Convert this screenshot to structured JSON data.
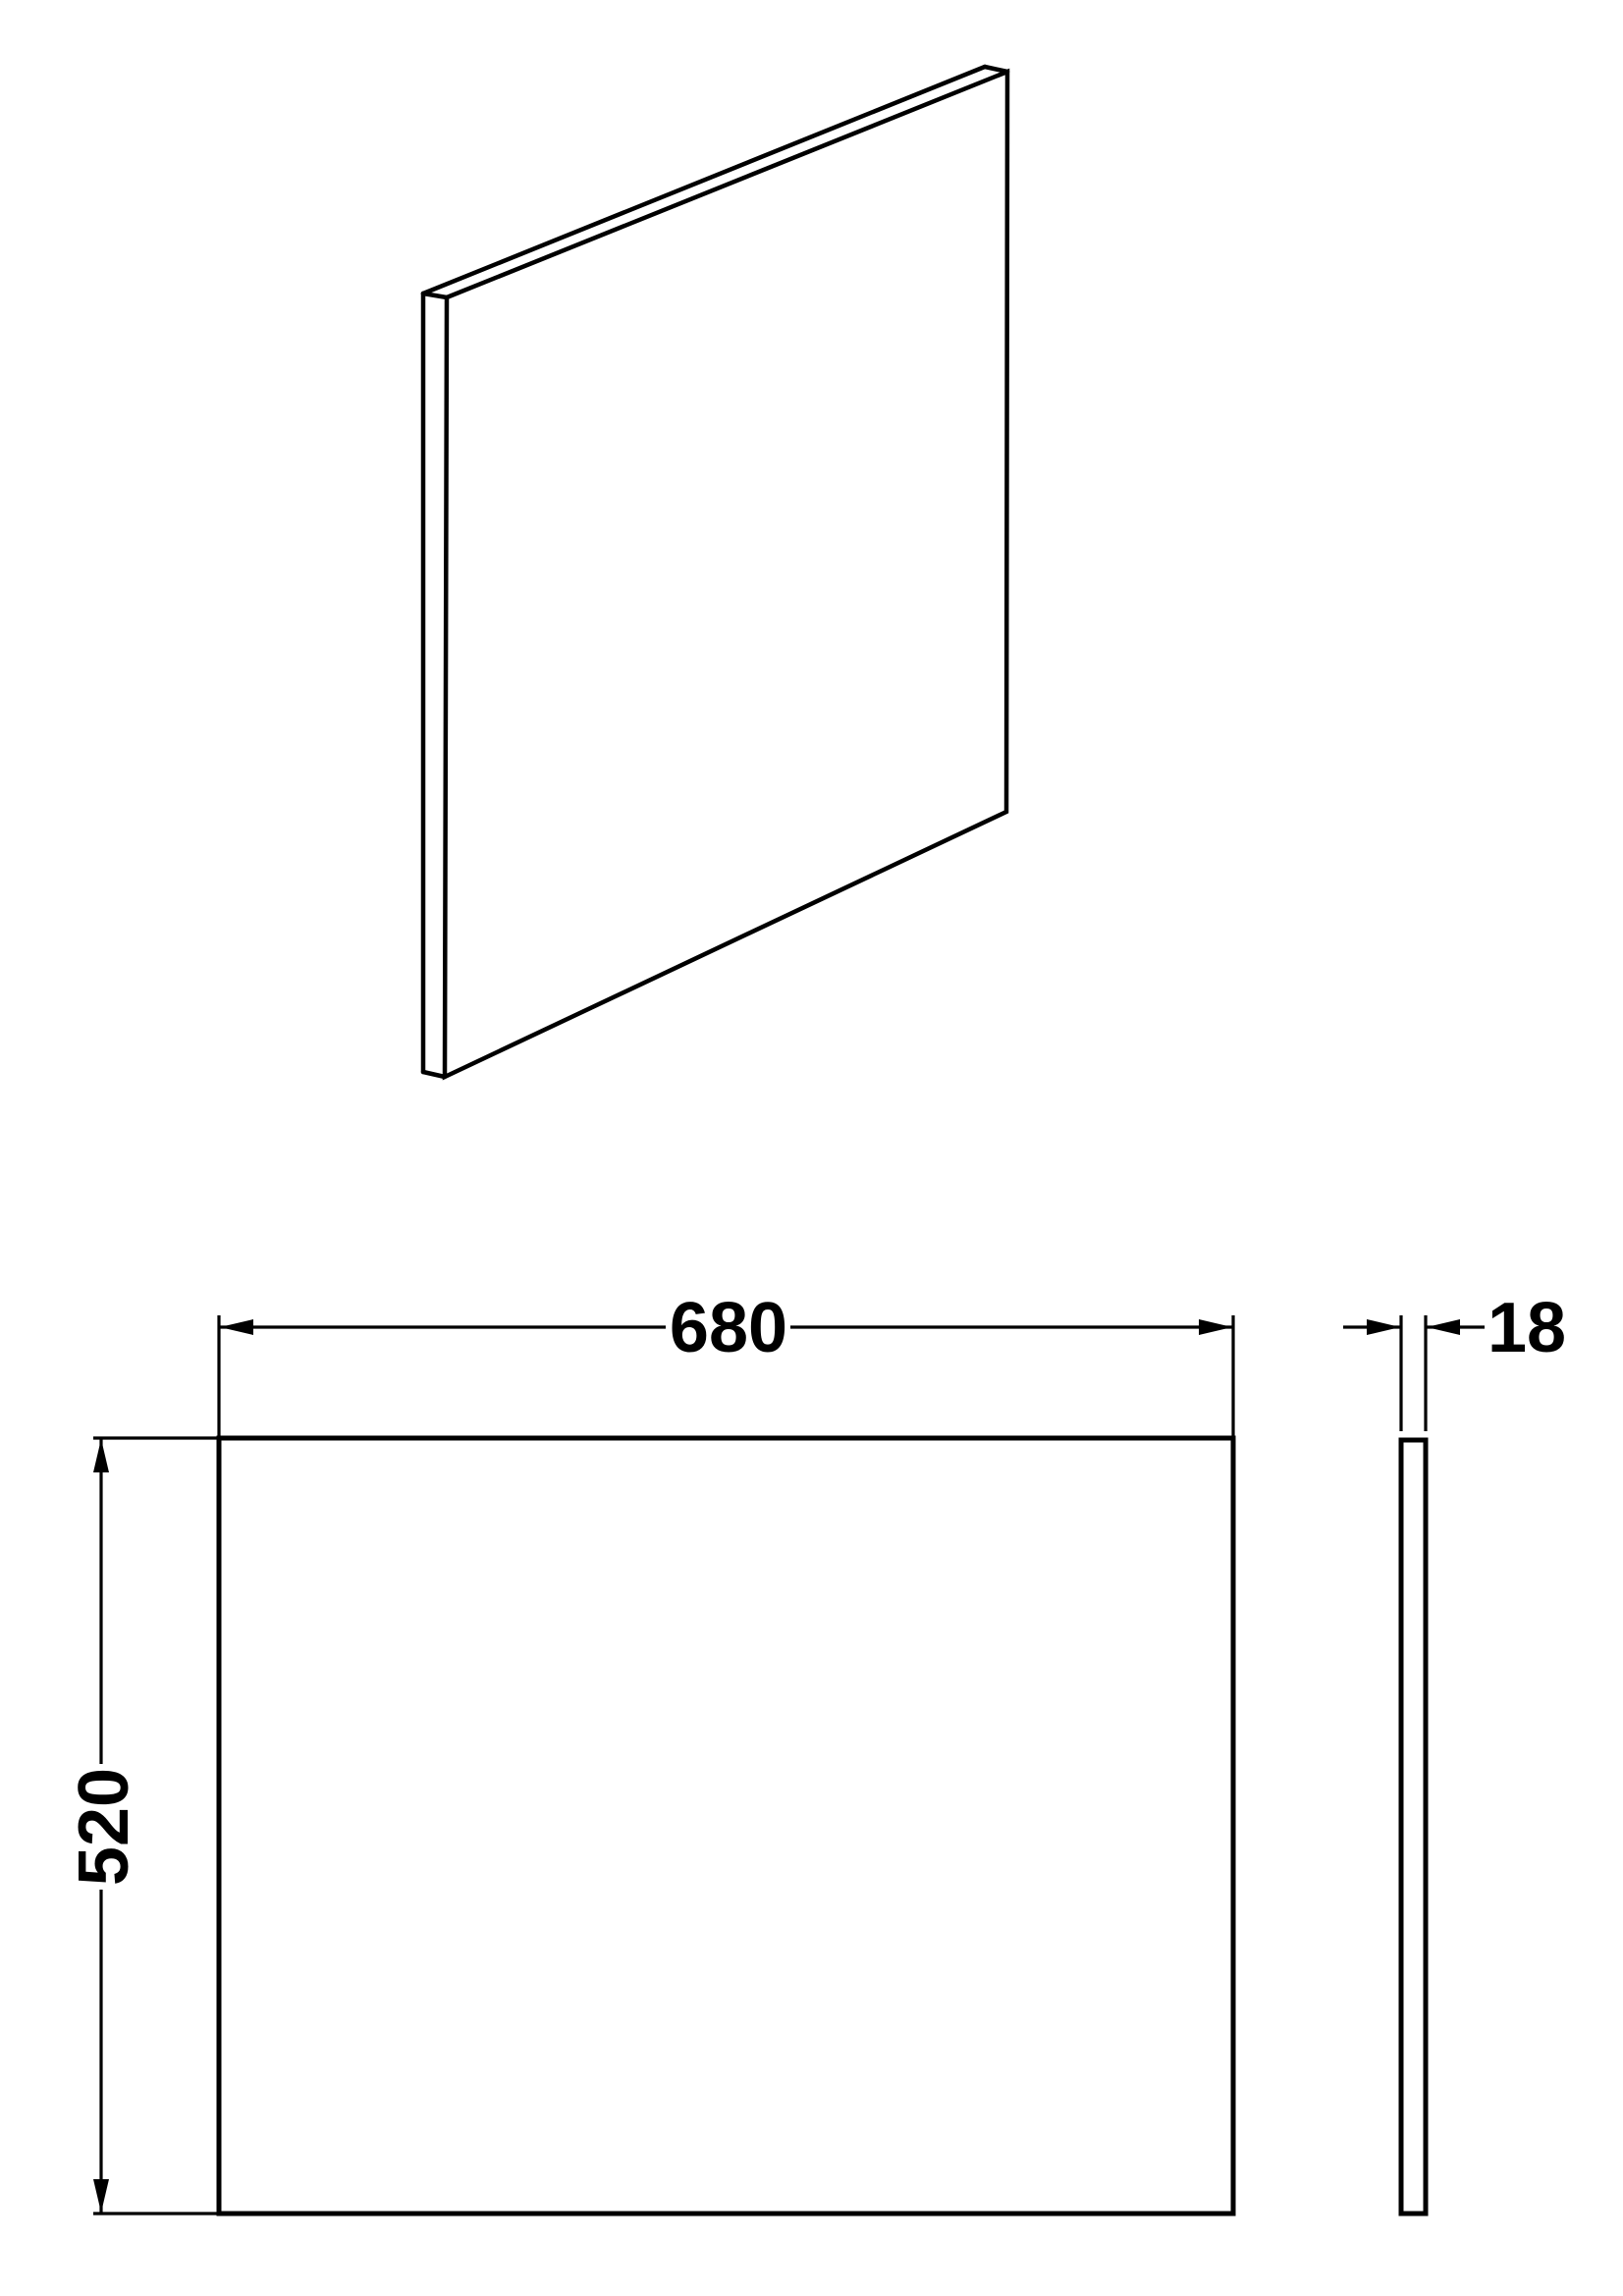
{
  "drawing": {
    "background_color": "#ffffff",
    "line_color": "#000000",
    "dimensions": {
      "width": "680",
      "height": "520",
      "thickness": "18"
    }
  }
}
